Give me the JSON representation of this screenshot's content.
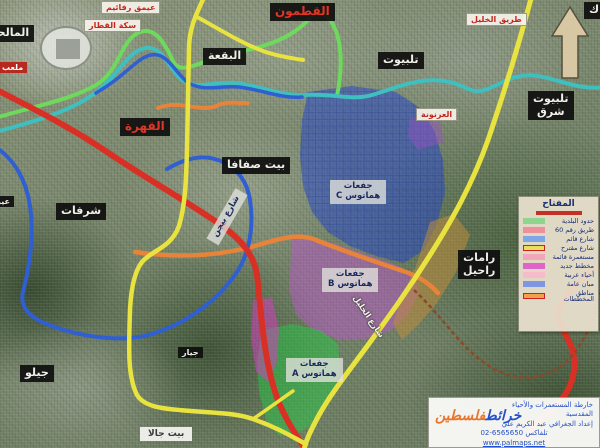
{
  "title": "خارطة المستعمرات والأحياء المقدسية - القدس",
  "badges": [
    {
      "name": "badge-malha",
      "style": "black",
      "x": -14,
      "y": 25,
      "lines": [
        "المالحة"
      ]
    },
    {
      "name": "badge-stadium",
      "style": "red",
      "x": -2,
      "y": 62,
      "lines": [
        "ملعب"
      ]
    },
    {
      "name": "badge-emek-refaim",
      "style": "white-red",
      "x": 101,
      "y": 1,
      "lines": [
        "عيمق رفائيم"
      ]
    },
    {
      "name": "badge-railway",
      "style": "white-red",
      "x": 84,
      "y": 19,
      "lines": [
        "سكة القطار"
      ]
    },
    {
      "name": "badge-qatamon",
      "style": "black-red",
      "x": 270,
      "y": 3,
      "lines": [
        "القطمون"
      ]
    },
    {
      "name": "badge-corner",
      "style": "black",
      "x": 584,
      "y": 2,
      "lines": [
        "ك"
      ]
    },
    {
      "name": "badge-baqaa",
      "style": "black",
      "x": 203,
      "y": 48,
      "lines": [
        "البقعة"
      ]
    },
    {
      "name": "badge-talpiot",
      "style": "black",
      "x": 378,
      "y": 52,
      "lines": [
        "تلبيوت"
      ]
    },
    {
      "name": "badge-hebron-road",
      "style": "white-red",
      "x": 466,
      "y": 13,
      "lines": [
        "طريق الخليل"
      ]
    },
    {
      "name": "badge-talpiot-east",
      "style": "black",
      "x": 528,
      "y": 91,
      "lines": [
        "تلبيوت",
        "شرق"
      ]
    },
    {
      "name": "badge-qahira",
      "style": "black-red",
      "x": 120,
      "y": 118,
      "lines": [
        "القهرة"
      ]
    },
    {
      "name": "badge-beit-safafa",
      "style": "black",
      "x": 222,
      "y": 157,
      "lines": [
        "بيت صفافا"
      ]
    },
    {
      "name": "badge-arnona",
      "style": "white-red",
      "small": true,
      "x": 416,
      "y": 108,
      "lines": [
        "العرنونة"
      ]
    },
    {
      "name": "badge-sharafat",
      "style": "black",
      "x": 56,
      "y": 203,
      "lines": [
        "شرفات"
      ]
    },
    {
      "name": "badge-begin-road",
      "style": "gray",
      "x": 198,
      "y": 210,
      "rotate": -60,
      "lines": [
        "شارع بيجن"
      ]
    },
    {
      "name": "badge-givat-hamatos-c",
      "style": "gray",
      "x": 330,
      "y": 180,
      "lines": [
        "جفعات",
        "هماتوس C"
      ]
    },
    {
      "name": "badge-givat-hamatos-b",
      "style": "gray",
      "x": 322,
      "y": 268,
      "lines": [
        "جفعات",
        "هماتوس B"
      ]
    },
    {
      "name": "badge-givat-hamatos-a",
      "style": "gray",
      "x": 286,
      "y": 358,
      "lines": [
        "جفعات",
        "هماتوس A"
      ]
    },
    {
      "name": "badge-ramat-rachel",
      "style": "black",
      "x": 458,
      "y": 250,
      "lines": [
        "رامات",
        "راحيل"
      ]
    },
    {
      "name": "badge-gilo",
      "style": "black",
      "x": 20,
      "y": 365,
      "lines": [
        "جيلو"
      ]
    },
    {
      "name": "badge-giyar",
      "style": "black",
      "small": true,
      "x": 178,
      "y": 347,
      "lines": [
        "جيار"
      ]
    },
    {
      "name": "badge-beit-jala",
      "style": "white-dark",
      "x": 140,
      "y": 427,
      "lines": [
        "بيت جالا"
      ]
    },
    {
      "name": "label-hebron-road-south",
      "style": "road-label",
      "x": 344,
      "y": 312,
      "rotate": 56,
      "lines": [
        "شارع الخليل"
      ]
    },
    {
      "name": "badge-ein-edge",
      "style": "black",
      "small": true,
      "x": -10,
      "y": 196,
      "lines": [
        "عين"
      ]
    }
  ],
  "legend": {
    "title": "المفتاح",
    "rows": [
      {
        "color": "#8fd48f",
        "label": "حدود البلدية"
      },
      {
        "color": "#ef8f9a",
        "label": "طريق رقم 60"
      },
      {
        "color": "#7fa6e6",
        "label": "شارع قائم"
      },
      {
        "color": "#e9df5d",
        "border": "#cc2222",
        "label": "شارع مقترح"
      },
      {
        "color": "#f2a6ba",
        "label": "مستعمرة قائمة"
      },
      {
        "color": "#e263c8",
        "label": "مخطط جديد"
      },
      {
        "color": "#f7bcca",
        "label": "أحياء عربية"
      },
      {
        "color": "#7f97e2",
        "label": "مبان عامة"
      },
      {
        "color": "#f1a04b",
        "border": "#cc2222",
        "label": "مناطق المخططات"
      }
    ]
  },
  "caption": {
    "logo_main": "خرائط",
    "logo_accent": "فلسطين",
    "lines": [
      "خارطة المستعمرات والأحياء المقدسية",
      "إعداد الجغرافي عبد الكريم علي",
      "تلفاكس 6565650-02",
      "www.palmaps.net"
    ]
  },
  "road_colors": {
    "yellow": "#e9e33f",
    "red": "#d93025",
    "green": "#6ed95c",
    "teal": "#3fbfbf",
    "blue": "#2f5fd0",
    "orange": "#e8833a",
    "trail": "#8a4a2a"
  },
  "area_colors": {
    "blue_zone": "rgba(35,70,205,0.5)",
    "purple_zone": "rgba(200,80,220,0.42)",
    "green_zone": "rgba(40,200,70,0.5)",
    "tan_strip": "rgba(190,140,60,0.55)",
    "magenta_strip": "rgba(220,60,200,0.5)",
    "small_purple": "rgba(150,80,200,0.45)",
    "arrow": "#d8c7a3"
  }
}
